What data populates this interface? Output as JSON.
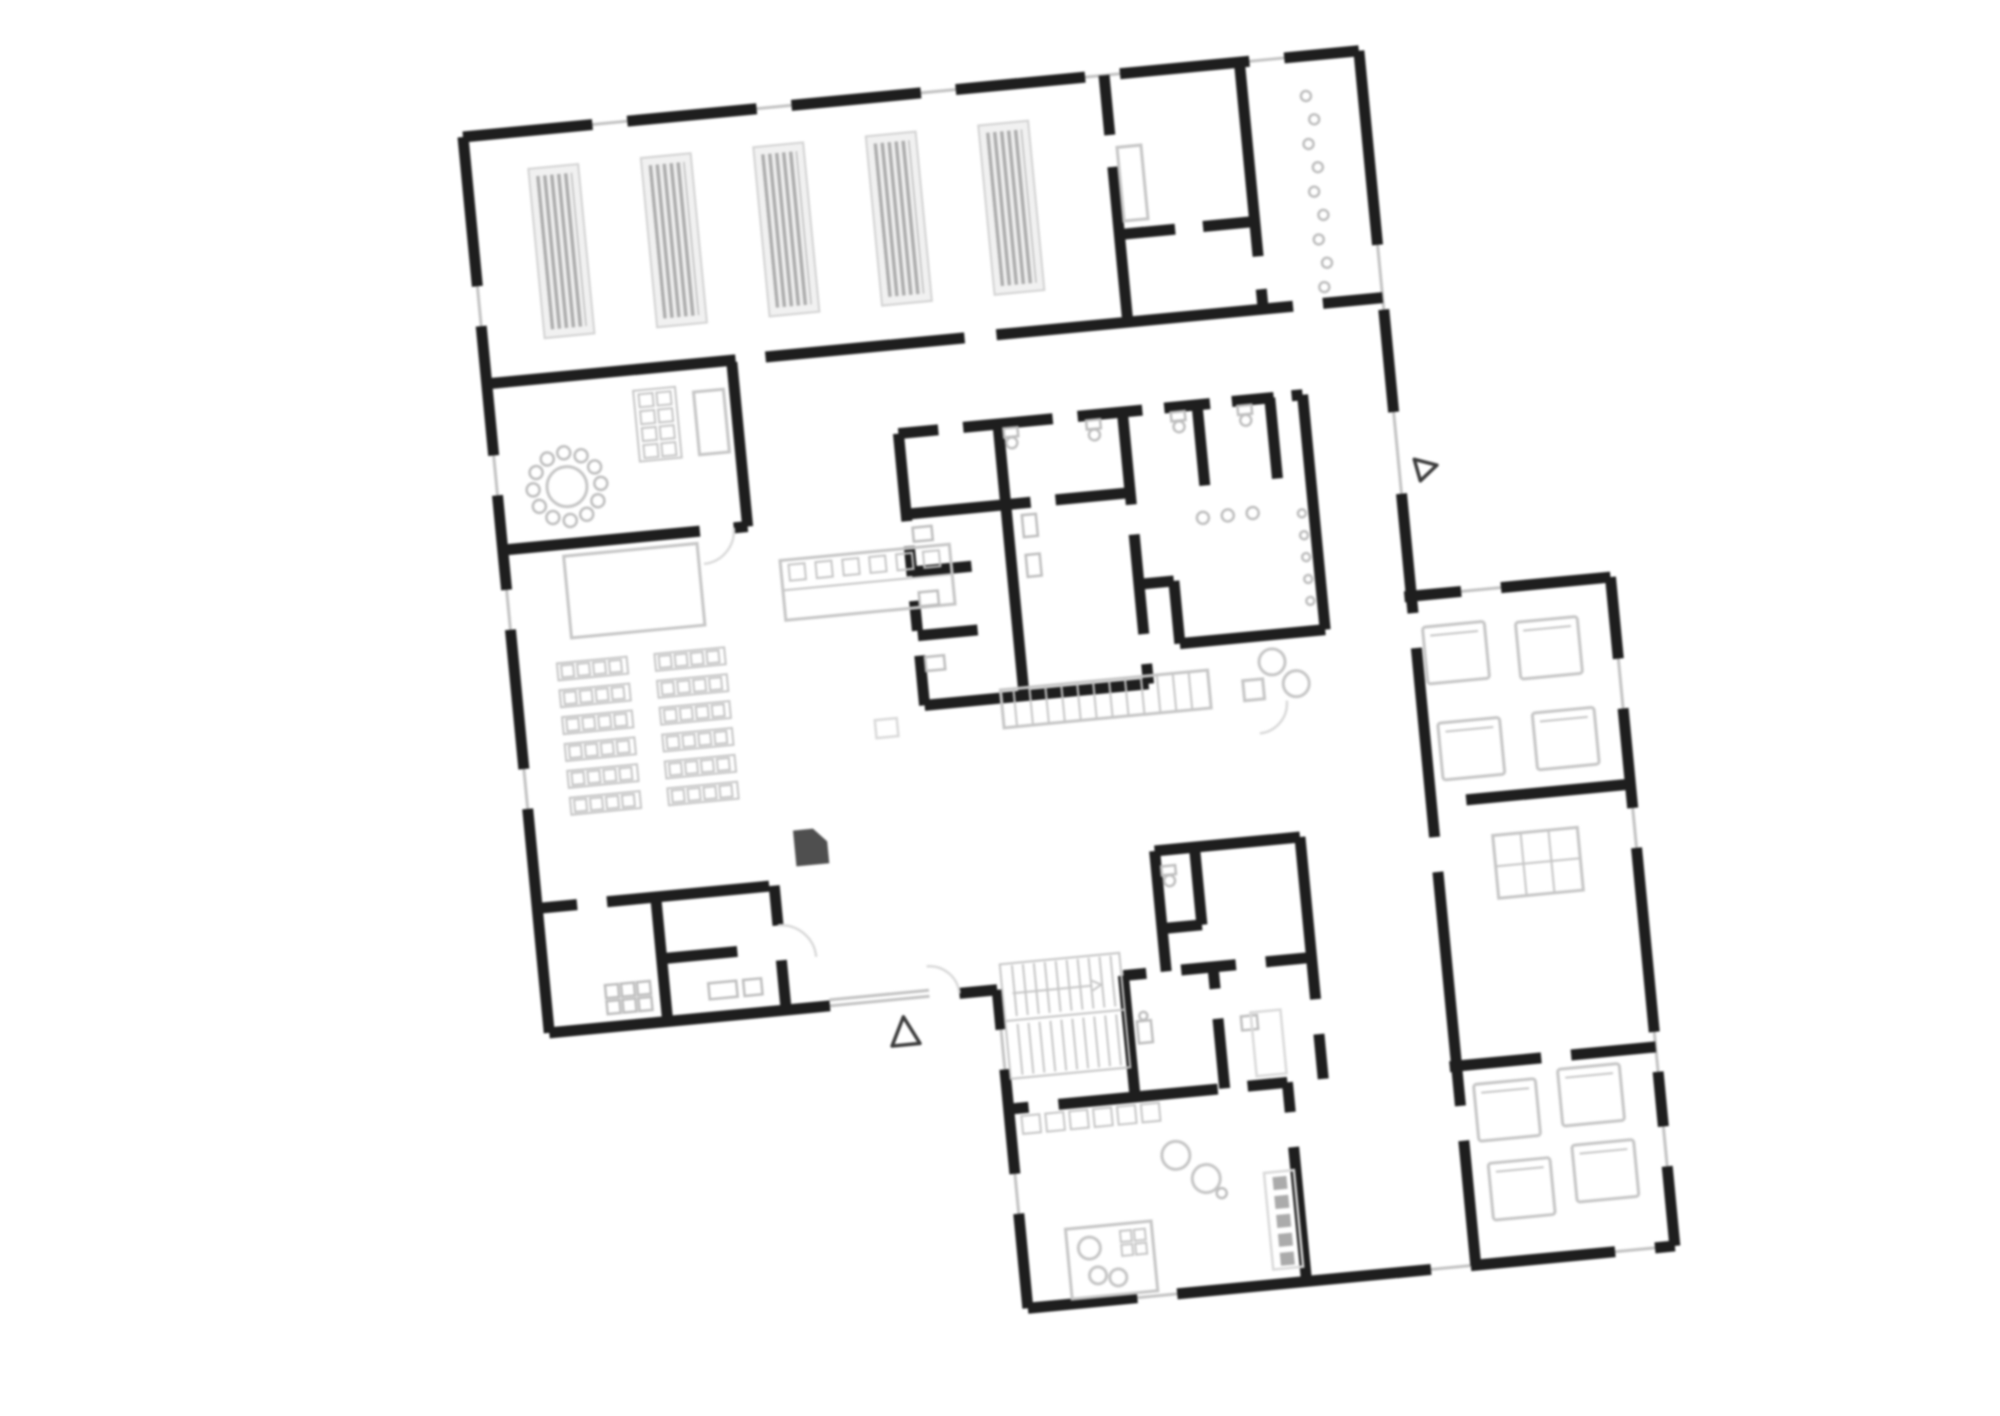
{
  "palette": {
    "paper": "#ffffff",
    "wall": "#1e1e1e",
    "window": "#c2c2c2",
    "furniture": "#c5c5c5",
    "fixture": "#bdbdbd",
    "pale": "#d9d9d9",
    "furniture_dark": "#4f4f4f",
    "rack_fill": "#f0f0f0",
    "rack_stripe": "#ababab"
  },
  "plan": {
    "rotation_deg": -5.5,
    "blocks": 2,
    "entrance_markers": 2,
    "storage_racks": 5,
    "round_table_chairs": 12,
    "classroom_desk_rows": 12,
    "coat_hooks": 9,
    "beds_upper_room": 4,
    "beds_lower_room": 4,
    "stair_flights": 2
  }
}
